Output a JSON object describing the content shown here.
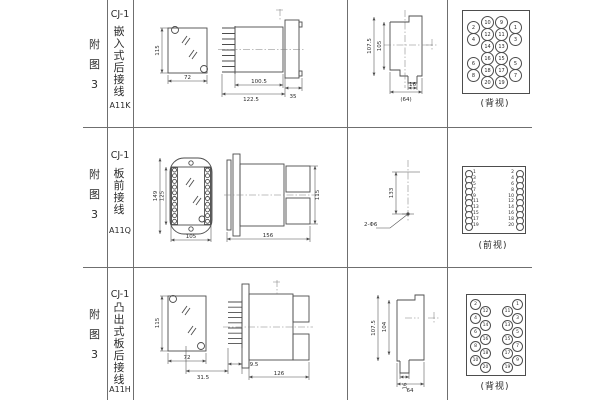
{
  "page": {
    "bg": "#ffffff",
    "line_color": "#6f6f6f",
    "ink_color": "#4d4d4d"
  },
  "rows": [
    {
      "fig_label": "附图3",
      "model": "CJ-1",
      "mount_type": "嵌入式后接线",
      "code": "A11K",
      "front_view": {
        "height_dim": "115",
        "width_dim": "72"
      },
      "side_view": {
        "dim_body": "100.5",
        "dim_overall": "122.5",
        "dim_flange": "35"
      },
      "cutout_view": {
        "dim_outer_h": "107.5",
        "dim_inner_h": "105",
        "dim_tab": "16",
        "dim_width": "(64)"
      },
      "terminal_view": {
        "label": "(背视)",
        "rows": [
          [
            "2",
            "10",
            "9",
            "1"
          ],
          [
            "4",
            "12",
            "11",
            "3"
          ],
          [
            "",
            "14",
            "13",
            ""
          ],
          [
            "6",
            "16",
            "15",
            "5"
          ],
          [
            "8",
            "18",
            "17",
            "7"
          ],
          [
            "",
            "20",
            "19",
            ""
          ]
        ]
      }
    },
    {
      "fig_label": "附图3",
      "model": "CJ-1",
      "mount_type": "板前接线",
      "code": "A11Q",
      "front_view": {
        "dim_outer_h": "149",
        "dim_inner_h": "125",
        "dim_width": "105"
      },
      "side_view": {
        "dim_length": "156",
        "dim_height": "115"
      },
      "drill_view": {
        "dim_spacing": "133",
        "hole_label": "2-Φ6"
      },
      "terminal_view": {
        "label": "(前视)",
        "left_numbers": [
          "1",
          "3",
          "5",
          "7",
          "9",
          "11",
          "13",
          "15",
          "17",
          "19"
        ],
        "right_numbers": [
          "2",
          "4",
          "6",
          "8",
          "10",
          "12",
          "14",
          "16",
          "18",
          "20"
        ]
      }
    },
    {
      "fig_label": "附图3",
      "model": "CJ-1",
      "mount_type": "凸出式板后接线",
      "code": "A11H",
      "front_view": {
        "height_dim": "115",
        "width_dim": "72"
      },
      "side_view": {
        "dim_base": "31.5",
        "dim_gap": "9.5",
        "dim_length": "126"
      },
      "cutout_view": {
        "dim_outer_h": "107.5",
        "dim_inner_h": "104",
        "dim_tab": "16",
        "dim_width": "64"
      },
      "terminal_view": {
        "label": "(背视)",
        "col1": [
          "2",
          "4",
          "6",
          "8",
          "10"
        ],
        "col2": [
          "12",
          "14",
          "16",
          "18",
          "20"
        ],
        "col3": [
          "11",
          "13",
          "15",
          "17",
          "19"
        ],
        "col4": [
          "1",
          "3",
          "5",
          "7",
          "9"
        ]
      }
    }
  ]
}
